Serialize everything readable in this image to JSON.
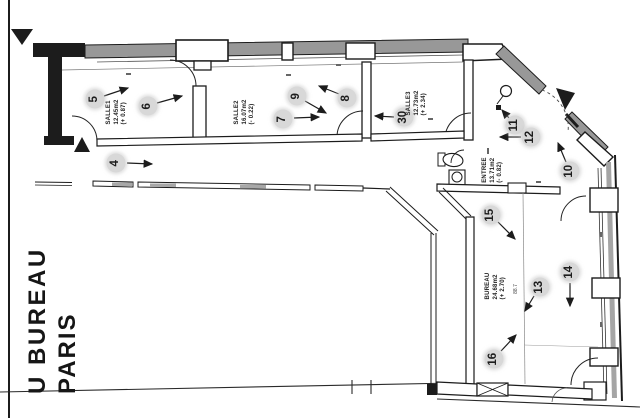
{
  "title_block": {
    "line1": "U BUREAU",
    "line2": "PARIS"
  },
  "rooms": [
    {
      "name": "SALLE1",
      "area": "12.45m2",
      "level": "(+ 0.87)",
      "x": 117,
      "y": 112
    },
    {
      "name": "SALLE2",
      "area": "16.07m2",
      "level": "(- 0.22)",
      "x": 245,
      "y": 112
    },
    {
      "name": "SALLE3",
      "area": "12.73m2",
      "level": "(+ 2.34)",
      "x": 417,
      "y": 103
    },
    {
      "name": "ENTREE",
      "area": "13.71m2",
      "level": "(- 0.82)",
      "x": 493,
      "y": 170
    },
    {
      "name": "BUREAU",
      "area": "24.68m2",
      "level": "(+ 2.70)",
      "x": 496,
      "y": 286
    }
  ],
  "markers": [
    {
      "label": "4",
      "x": 116,
      "y": 163,
      "ax1": 127,
      "ay1": 163,
      "ax2": 152,
      "ay2": 164
    },
    {
      "label": "5",
      "x": 95,
      "y": 99,
      "ax1": 104,
      "ay1": 96,
      "ax2": 128,
      "ay2": 88
    },
    {
      "label": "6",
      "x": 148,
      "y": 106,
      "ax1": 157,
      "ay1": 103,
      "ax2": 182,
      "ay2": 96
    },
    {
      "label": "7",
      "x": 283,
      "y": 119,
      "ax1": 294,
      "ay1": 118,
      "ax2": 319,
      "ay2": 117
    },
    {
      "label": "8",
      "x": 347,
      "y": 98,
      "ax1": 339,
      "ay1": 94,
      "ax2": 319,
      "ay2": 86
    },
    {
      "label": "9",
      "x": 297,
      "y": 96,
      "ax1": 305,
      "ay1": 101,
      "ax2": 326,
      "ay2": 113
    },
    {
      "label": "30",
      "x": 404,
      "y": 117,
      "ax1": 394,
      "ay1": 117,
      "ax2": 375,
      "ay2": 116
    },
    {
      "label": "11",
      "x": 515,
      "y": 125,
      "ax1": 509,
      "ay1": 118,
      "ax2": 502,
      "ay2": 110
    },
    {
      "label": "12",
      "x": 531,
      "y": 137,
      "ax1": 521,
      "ay1": 137,
      "ax2": 500,
      "ay2": 137
    },
    {
      "label": "10",
      "x": 570,
      "y": 171,
      "ax1": 566,
      "ay1": 162,
      "ax2": 558,
      "ay2": 143
    },
    {
      "label": "15",
      "x": 491,
      "y": 215,
      "ax1": 498,
      "ay1": 222,
      "ax2": 515,
      "ay2": 239
    },
    {
      "label": "13",
      "x": 540,
      "y": 287,
      "ax1": 534,
      "ay1": 296,
      "ax2": 525,
      "ay2": 311
    },
    {
      "label": "14",
      "x": 570,
      "y": 272,
      "ax1": 570,
      "ay1": 283,
      "ax2": 570,
      "ay2": 306
    },
    {
      "label": "16",
      "x": 494,
      "y": 359,
      "ax1": 501,
      "ay1": 351,
      "ax2": 516,
      "ay2": 335
    }
  ],
  "annotations": {
    "dim": "88.7",
    "dim_x": 516,
    "dim_y": 289
  },
  "colors": {
    "ink": "#1c1c1c",
    "wall_gray": "#989898",
    "marker_halo": "#d8d8d8",
    "paper": "#ffffff"
  }
}
